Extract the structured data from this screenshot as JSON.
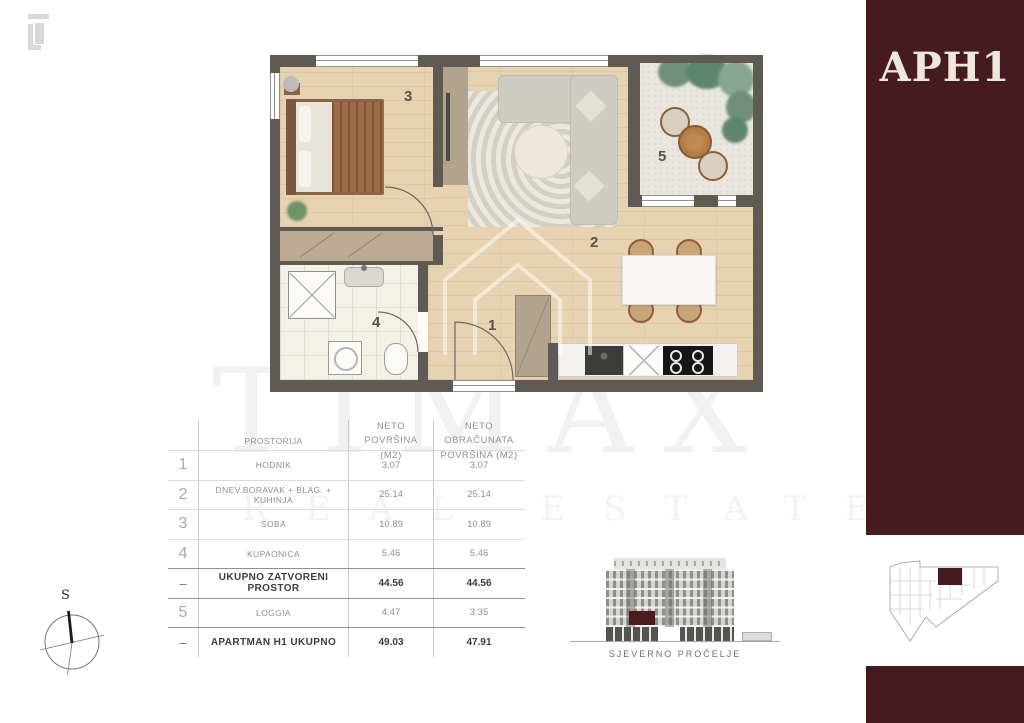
{
  "branding": {
    "unit_label": "APH1",
    "watermark_line1": "TIMAX",
    "watermark_line2": "REAL ESTATE",
    "logo": "timax-logo"
  },
  "colors": {
    "accent_maroon": "#451a20",
    "wall_gray": "#5f5b54",
    "wood_floor": "#e7d3b1",
    "cream_text": "#efe7db"
  },
  "compass": {
    "north_label": "S"
  },
  "floorplan": {
    "room_labels": [
      "1",
      "2",
      "3",
      "4",
      "5"
    ]
  },
  "table": {
    "header": {
      "prostorija": "PROSTORIJA",
      "neto": "NETO POVRŠINA (M2)",
      "obracunata": "NETO OBRAČUNATA POVRŠINA (M2)"
    },
    "rows": [
      {
        "num": "1",
        "name": "HODNIK",
        "neto": "3.07",
        "obr": "3.07"
      },
      {
        "num": "2",
        "name": "DNEV.BORAVAK + BLAG. + KUHINJA",
        "neto": "25.14",
        "obr": "25.14"
      },
      {
        "num": "3",
        "name": "SOBA",
        "neto": "10.89",
        "obr": "10.89"
      },
      {
        "num": "4",
        "name": "KUPAONICA",
        "neto": "5.46",
        "obr": "5.46"
      },
      {
        "num": "–",
        "name": "UKUPNO ZATVORENI PROSTOR",
        "neto": "44.56",
        "obr": "44.56"
      },
      {
        "num": "5",
        "name": "LOGGIA",
        "neto": "4.47",
        "obr": "3.35"
      },
      {
        "num": "–",
        "name": "APARTMAN H1 UKUPNO",
        "neto": "49.03",
        "obr": "47.91"
      }
    ]
  },
  "elevation": {
    "caption": "SJEVERNO PROČELJE"
  }
}
